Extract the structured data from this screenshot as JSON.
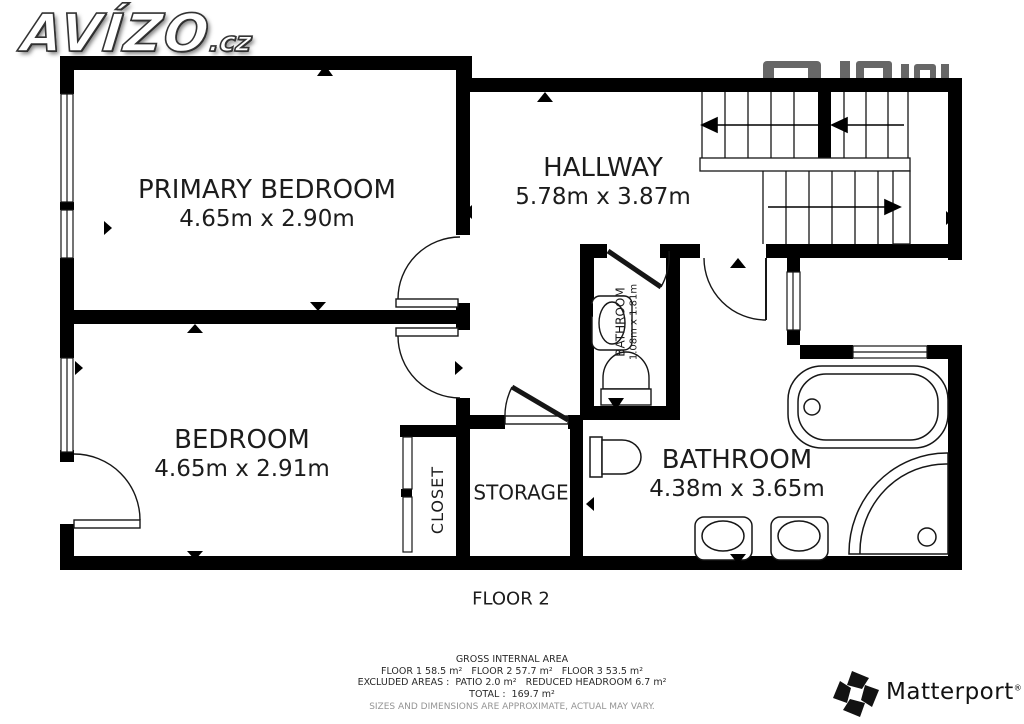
{
  "logo": {
    "text": "AVÍZO",
    "suffix": ".cz"
  },
  "rooms": {
    "primary_bedroom": {
      "name": "PRIMARY BEDROOM",
      "dims": "4.65m x 2.90m"
    },
    "hallway": {
      "name": "HALLWAY",
      "dims": "5.78m x 3.87m"
    },
    "bedroom": {
      "name": "BEDROOM",
      "dims": "4.65m x 2.91m"
    },
    "bathroom_small": {
      "name": "BATHROOM",
      "dims": "1.08m x 1.81m"
    },
    "bathroom": {
      "name": "BATHROOM",
      "dims": "4.38m x 3.65m"
    },
    "storage": {
      "name": "STORAGE"
    },
    "closet": {
      "name": "CLOSET"
    }
  },
  "floor_label": "FLOOR 2",
  "footer": {
    "title": "GROSS INTERNAL AREA",
    "line1": "FLOOR 1 58.5 m²   FLOOR 2 57.7 m²   FLOOR 3 53.5 m²",
    "line2": "EXCLUDED AREAS :  PATIO 2.0 m²   REDUCED HEADROOM 6.7 m²",
    "line3": "TOTAL :  169.7 m²",
    "disclaimer": "SIZES AND DIMENSIONS ARE APPROXIMATE, ACTUAL MAY VARY."
  },
  "branding": {
    "matterport": "Matterport",
    "registered": "®"
  },
  "colors": {
    "wall": "#000000",
    "line": "#161616",
    "muted": "#949494",
    "watermark": "#4d4d4d"
  }
}
